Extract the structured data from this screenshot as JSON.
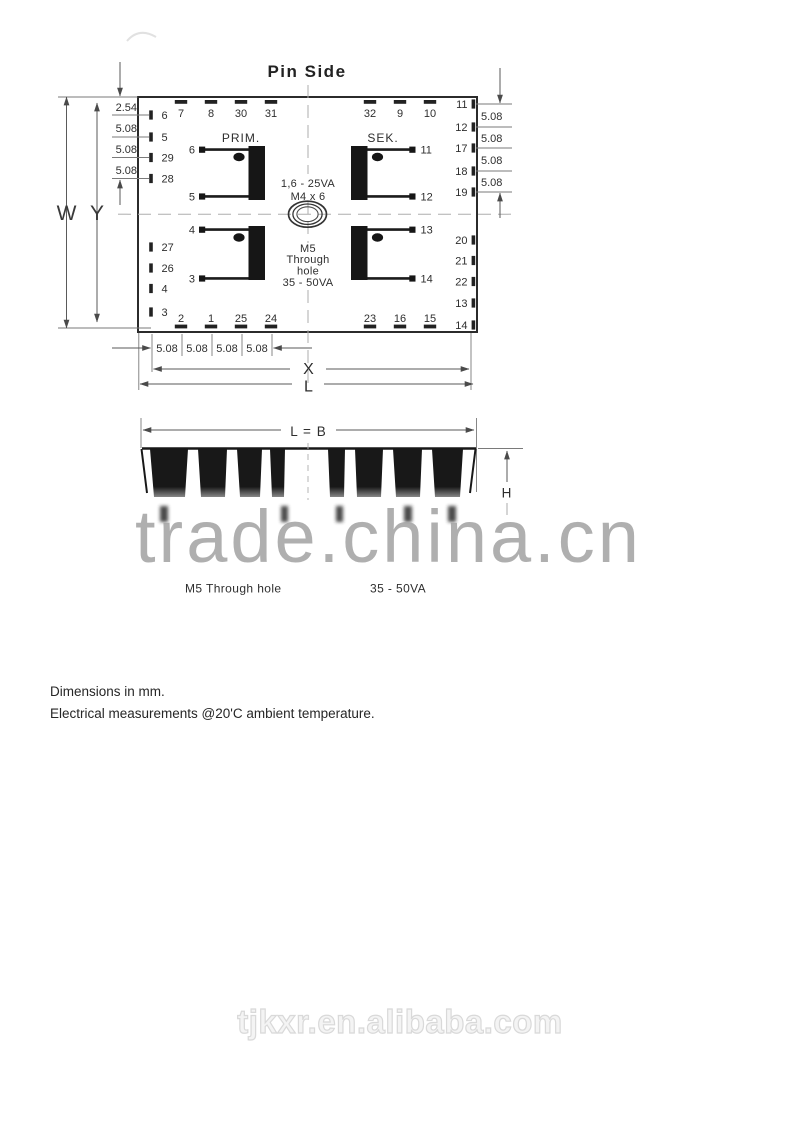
{
  "page": {
    "title": "Pin Side",
    "notes": [
      "Dimensions in mm.",
      "Electrical measurements @20'C ambient temperature."
    ],
    "watermarks": {
      "center": "trade.china.cn",
      "bottom": "tjkxr.en.alibaba.com"
    }
  },
  "colors": {
    "ink": "#2b2b2b",
    "coil_fill": "#161616",
    "watermark_center": "#a2a2a2",
    "watermark_bottom_outline": "#d9d9d9"
  },
  "pin_diagram": {
    "top_row_left": [
      "7",
      "8",
      "30",
      "31"
    ],
    "top_row_right": [
      "32",
      "9",
      "10"
    ],
    "bottom_row_left": [
      "2",
      "1",
      "25",
      "24"
    ],
    "bottom_row_right": [
      "23",
      "16",
      "15"
    ],
    "left_col_upper": [
      "6",
      "5",
      "29",
      "28"
    ],
    "left_col_lower": [
      "27",
      "26",
      "4",
      "3"
    ],
    "right_col_upper": [
      "11",
      "12",
      "17",
      "18",
      "19"
    ],
    "right_col_lower": [
      "20",
      "21",
      "22",
      "13",
      "14"
    ],
    "dims_left": [
      "2.54",
      "5.08",
      "5.08",
      "5.08"
    ],
    "dims_right": [
      "5.08",
      "5.08",
      "5.08",
      "5.08"
    ],
    "dims_bottom": [
      "5.08",
      "5.08",
      "5.08",
      "5.08"
    ],
    "width_letter": "W",
    "y_letter": "Y",
    "x_letter": "X",
    "l_letter": "L",
    "primary_label": "PRIM.",
    "secondary_label": "SEK.",
    "coils": {
      "tl": [
        "6",
        "5"
      ],
      "tr": [
        "11",
        "12"
      ],
      "bl": [
        "4",
        "3"
      ],
      "br": [
        "13",
        "14"
      ]
    },
    "center_note_upper": [
      "1,6 - 25VA",
      "M4 x 6"
    ],
    "center_note_lower": [
      "M5",
      "Through",
      "hole",
      "35 - 50VA"
    ]
  },
  "side_view": {
    "top_dim": "L = B",
    "height_dim": "H",
    "caption_mount": "M5 Through hole",
    "caption_power": "35 - 50VA"
  }
}
